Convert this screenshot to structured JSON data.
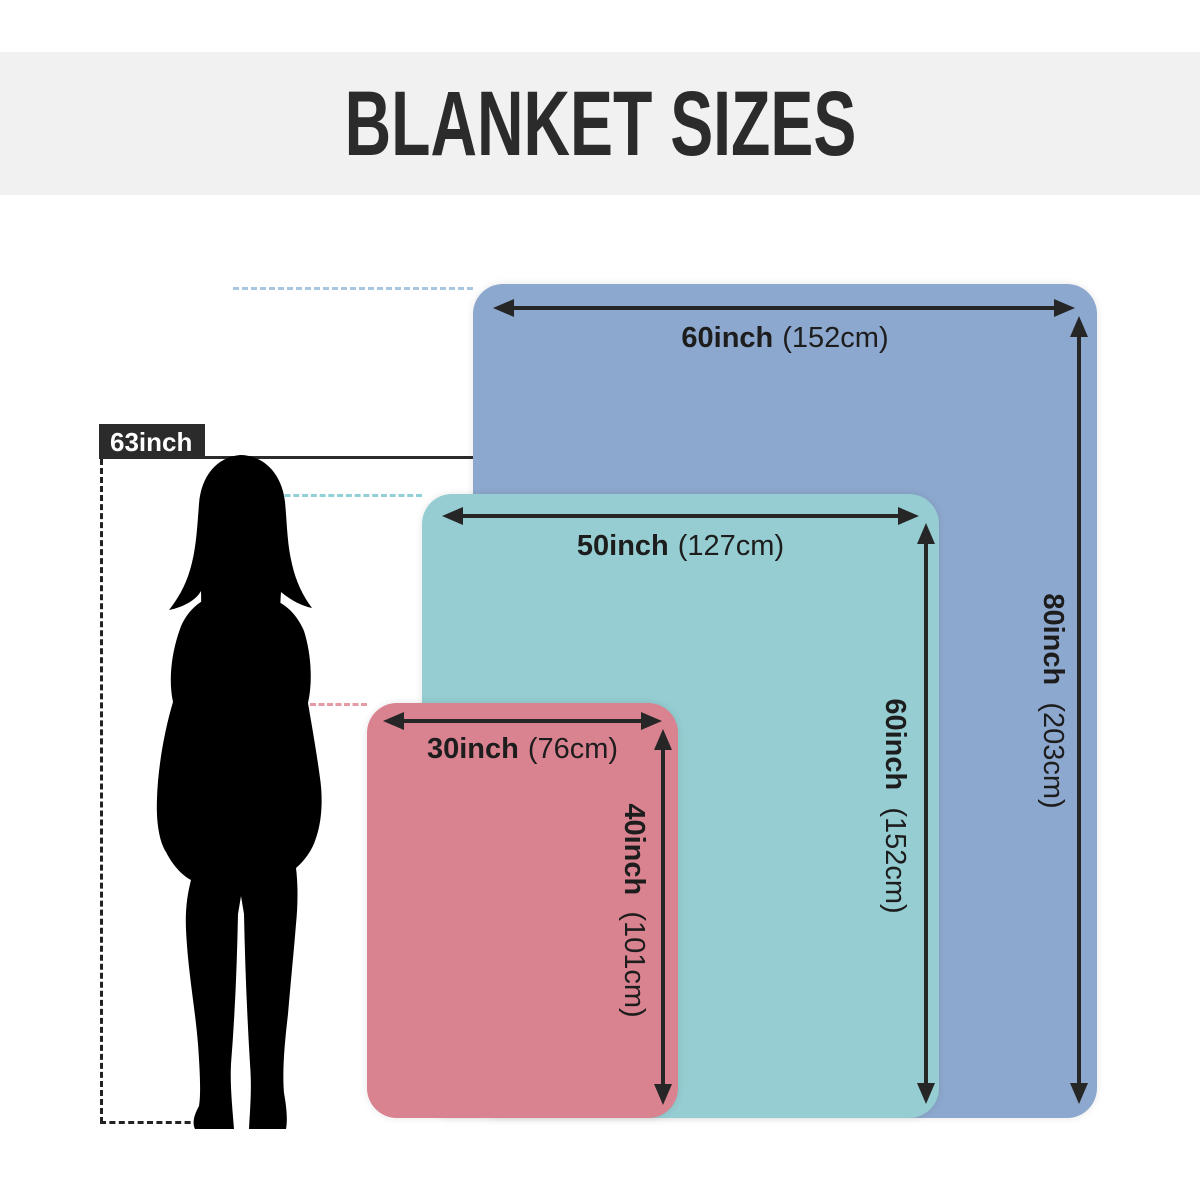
{
  "title": "BLANKET SIZES",
  "person": {
    "height_label": "63inch"
  },
  "blankets": [
    {
      "name": "large",
      "color": "#8da8ce",
      "width_in": "60inch",
      "width_cm": "(152cm)",
      "height_in": "80inch",
      "height_cm": "(203cm)"
    },
    {
      "name": "medium",
      "color": "#95cdd2",
      "width_in": "50inch",
      "width_cm": "(127cm)",
      "height_in": "60inch",
      "height_cm": "(152cm)"
    },
    {
      "name": "small",
      "color": "#d98290",
      "width_in": "30inch",
      "width_cm": "(76cm)",
      "height_in": "40inch",
      "height_cm": "(101cm)"
    }
  ],
  "colors": {
    "header_background": "#f1f1f1",
    "title_text": "#2b2b2b",
    "arrow": "#262626",
    "blue_dash": "#aac7e2",
    "teal_dash": "#8fd1d6",
    "pink_dash": "#e59aa6",
    "person_silhouette": "#000000",
    "height_tag_background": "#2b2b2b",
    "height_tag_text": "#ffffff"
  }
}
